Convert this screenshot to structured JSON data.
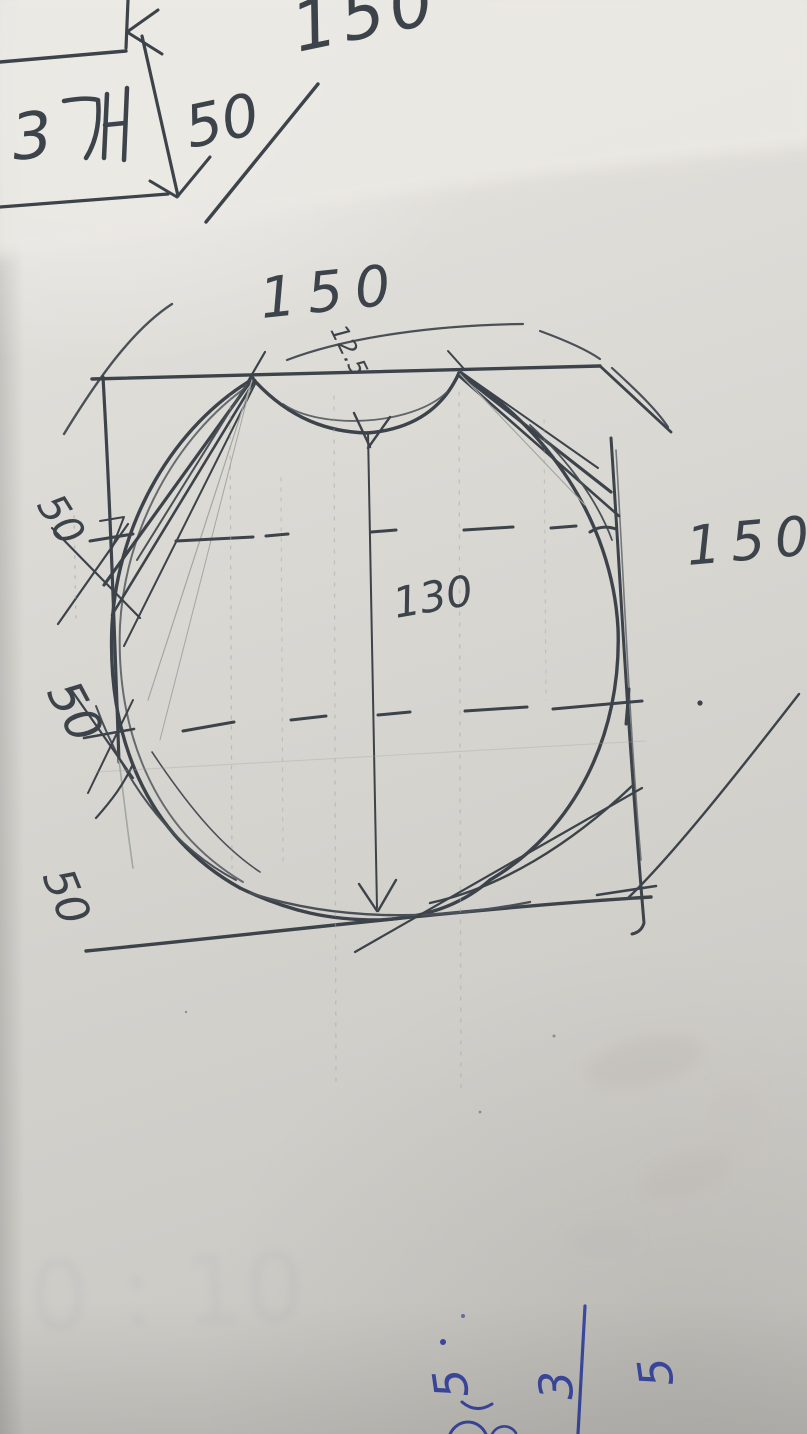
{
  "sketch": {
    "top_left_note": {
      "count": "3",
      "unit": "개",
      "quantity_value": "50"
    },
    "top_edge_number": "150",
    "pattern_labels": {
      "top_width": "150",
      "apex_small_note": "12.5",
      "center_height": "130",
      "right_side": "150",
      "left_offsets": [
        "50",
        "50",
        "50"
      ]
    },
    "bottom_blue_note": {
      "digits": [
        "5",
        "3",
        "5"
      ]
    },
    "ghost_backside_text": "0 : 10",
    "colors": {
      "ink": "#3d434a",
      "pencil": "#a2a7a4",
      "blue_ink": "#3b49a0",
      "paper": "#d9d7d2"
    }
  }
}
